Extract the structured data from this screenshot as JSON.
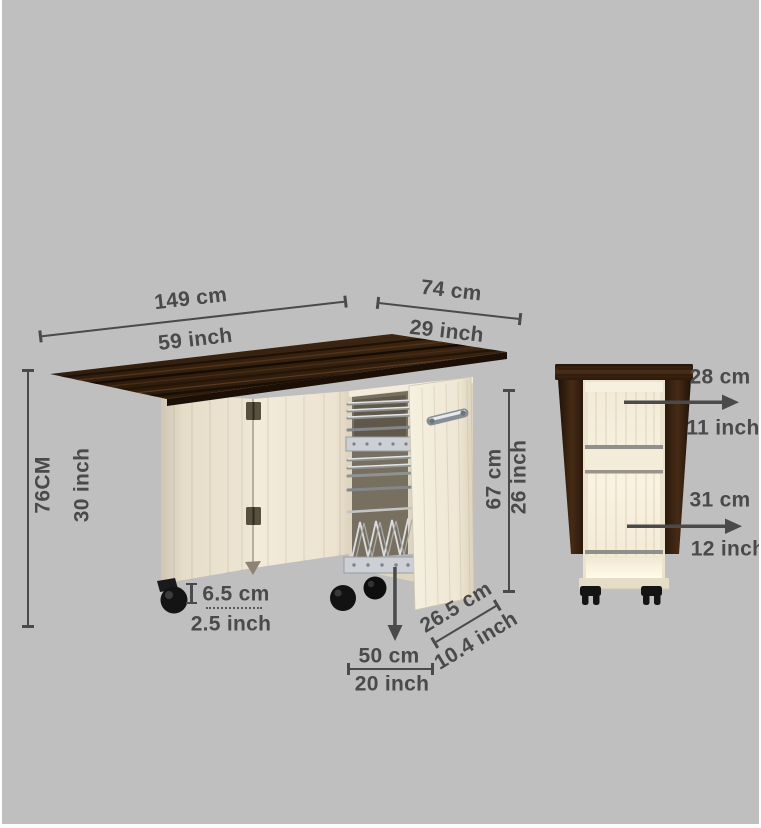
{
  "colors": {
    "background": "#bfbfbf",
    "text": "#4a4a4a",
    "dimension_line": "#4a4a4a",
    "tabletop_wood": "#35210f",
    "wood_dark": "#2b1a0c",
    "panel_cream": "#efe7d5",
    "panel_shade": "#d6ccb8",
    "chrome": "#c9cdd1",
    "caster_black": "#171717",
    "interior_glow": "#faf3e1"
  },
  "views": {
    "open_table": {
      "description": "folding table open view with pull-out trolley",
      "dimensions": {
        "length": {
          "metric": "149 cm",
          "imperial": "59 inch"
        },
        "depth": {
          "metric": "74 cm",
          "imperial": "29 inch"
        },
        "height": {
          "metric": "76CM",
          "imperial": "30 inch"
        },
        "caster_height": {
          "metric": "6.5 cm",
          "imperial": "2.5 inch"
        },
        "trolley_height": {
          "metric": "67 cm",
          "imperial": "26 inch"
        },
        "trolley_depth": {
          "metric": "50 cm",
          "imperial": "20 inch"
        },
        "trolley_width": {
          "metric": "26.5 cm",
          "imperial": "10.4 inch"
        }
      }
    },
    "folded_cabinet": {
      "description": "folded cabinet front view with shelves",
      "dimensions": {
        "upper_shelf": {
          "metric": "28 cm",
          "imperial": "11 inch"
        },
        "lower_shelf": {
          "metric": "31 cm",
          "imperial": "12 inch"
        }
      }
    }
  }
}
